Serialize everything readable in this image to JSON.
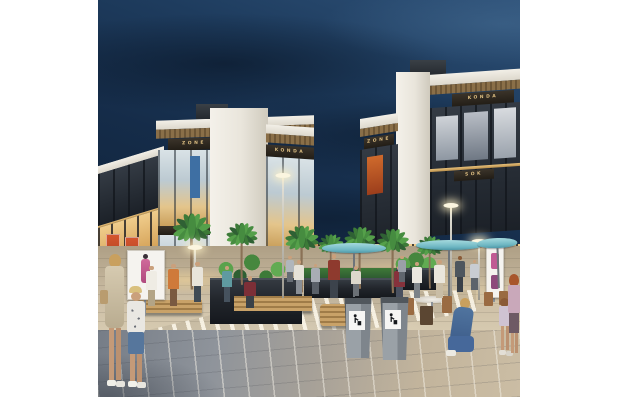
{
  "scene": {
    "title": "Evening architectural rendering of an open-air retail plaza",
    "time_of_day": "dusk",
    "signs": {
      "zone_a": "ZONE",
      "konda_a": "KONDA",
      "zone_lower": "ZONE",
      "konda_top": "KONDA",
      "zone_b": "ZONE",
      "sok": "SOK"
    },
    "colors": {
      "sky_top": "#2e5178",
      "sky_deep": "#0d1f34",
      "building_frame": "#f2efe7",
      "storefront_glow": "#d8a75e",
      "sign_band": "#2c2620",
      "sign_text": "#dcbd81",
      "palm_green": "#46873e",
      "plaza_warm": "#cbbda4",
      "crosswalk_stripe": "#faf5e8",
      "foreground_cool": "#8f949b",
      "umbrella_teal": "#6db6c2",
      "bin_gray": "#9aa1a7",
      "banner_red": "#d4552e"
    }
  }
}
